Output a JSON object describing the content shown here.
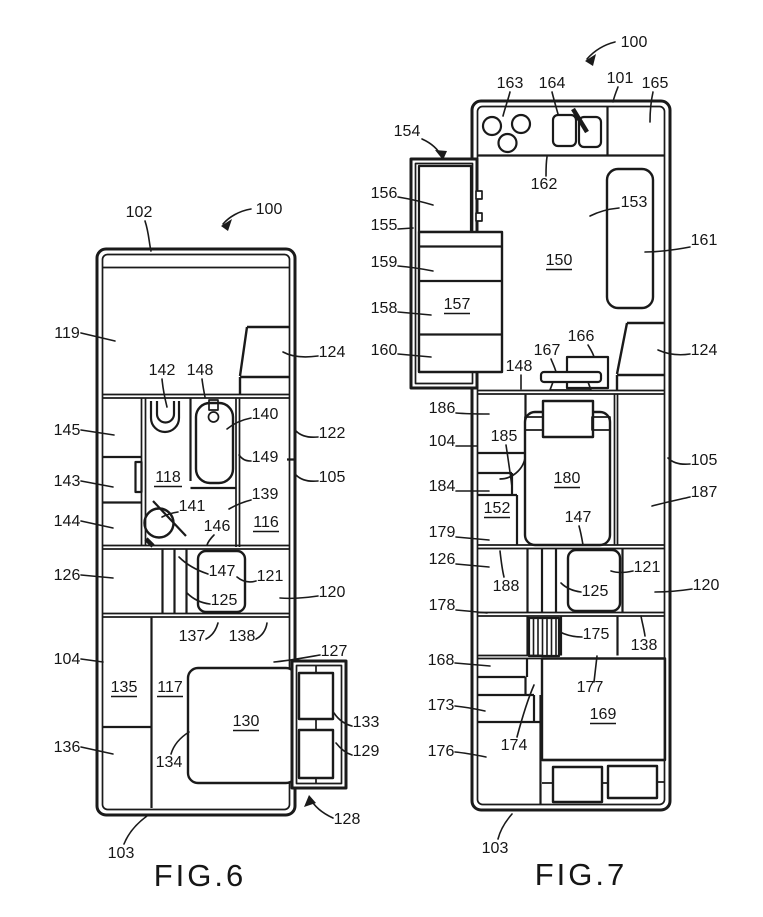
{
  "figure6": {
    "caption": "FIG.6",
    "labels": {
      "100": "100",
      "102": "102",
      "103": "103",
      "104": "104",
      "105": "105",
      "116": "116",
      "117": "117",
      "118": "118",
      "119": "119",
      "120": "120",
      "121": "121",
      "122": "122",
      "124": "124",
      "125": "125",
      "126": "126",
      "127": "127",
      "128": "128",
      "129": "129",
      "130": "130",
      "133": "133",
      "134": "134",
      "135": "135",
      "136": "136",
      "137": "137",
      "138": "138",
      "139": "139",
      "140": "140",
      "141": "141",
      "142": "142",
      "143": "143",
      "144": "144",
      "145": "145",
      "146": "146",
      "147": "147",
      "148": "148",
      "149": "149"
    }
  },
  "figure7": {
    "caption": "FIG.7",
    "labels": {
      "100": "100",
      "101": "101",
      "103": "103",
      "104": "104",
      "105": "105",
      "120": "120",
      "121": "121",
      "124": "124",
      "125": "125",
      "126": "126",
      "138": "138",
      "147": "147",
      "148": "148",
      "150": "150",
      "151": "151",
      "152": "152",
      "153": "153",
      "154": "154",
      "155": "155",
      "156": "156",
      "157": "157",
      "158": "158",
      "159": "159",
      "160": "160",
      "161": "161",
      "162": "162",
      "163": "163",
      "164": "164",
      "165": "165",
      "166": "166",
      "167": "167",
      "168": "168",
      "169": "169",
      "173": "173",
      "174": "174",
      "175": "175",
      "176": "176",
      "177": "177",
      "178": "178",
      "179": "179",
      "180": "180",
      "184": "184",
      "185": "185",
      "186": "186",
      "187": "187",
      "188": "188"
    }
  }
}
